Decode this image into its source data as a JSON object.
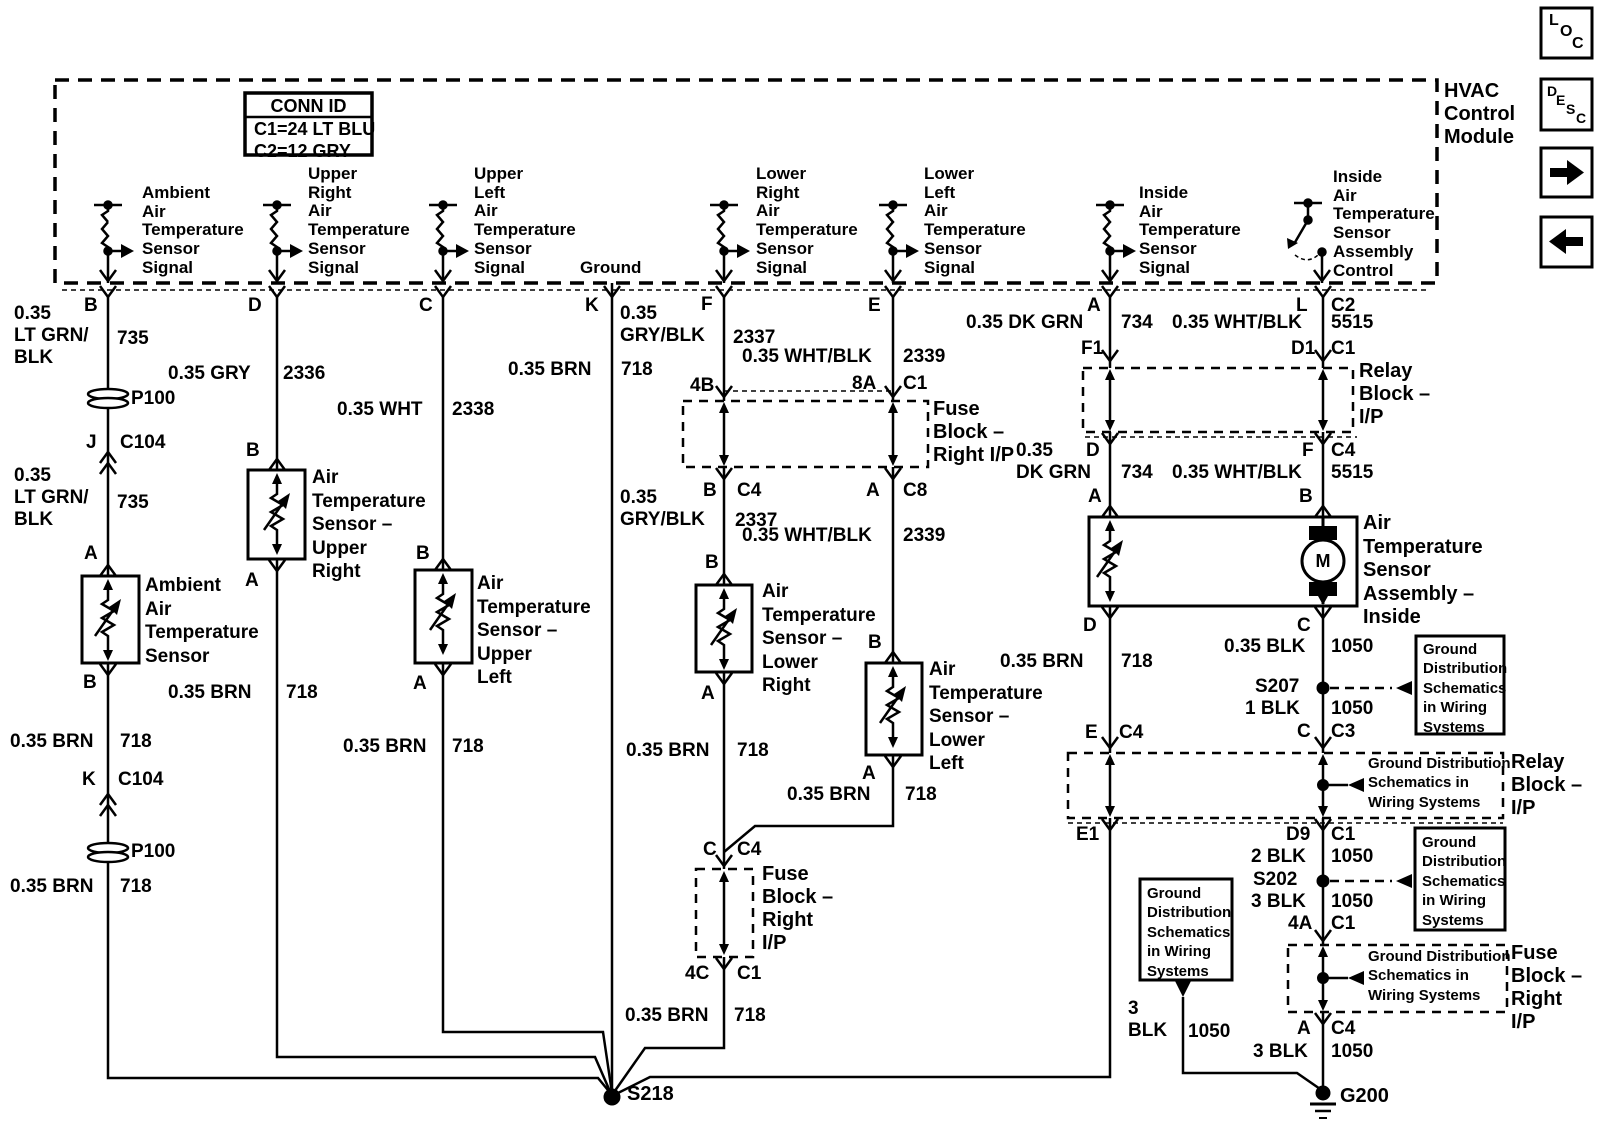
{
  "hdr": {
    "conn_title": "CONN ID",
    "conn_c1": "C1=24 LT BLU",
    "conn_c2": "C2=12 GRY",
    "module": "HVAC\nControl\nModule"
  },
  "icons": {
    "loc_l": "L",
    "loc_o": "O",
    "loc_c": "C",
    "desc_d": "D",
    "desc_e": "E",
    "desc_s": "S",
    "desc_c": "C"
  },
  "sens": {
    "ambient": "Ambient\nAir\nTemperature\nSensor\nSignal",
    "upper_right": "Upper\nRight\nAir\nTemperature\nSensor\nSignal",
    "upper_left": "Upper\nLeft\nAir\nTemperature\nSensor\nSignal",
    "ground": "Ground",
    "lower_right": "Lower\nRight\nAir\nTemperature\nSensor\nSignal",
    "lower_left": "Lower\nLeft\nAir\nTemperature\nSensor\nSignal",
    "inside": "Inside\nAir\nTemperature\nSensor\nSignal",
    "inside_ctrl": "Inside\nAir\nTemperature\nSensor\nAssembly\nControl"
  },
  "pins": {
    "b": "B",
    "d": "D",
    "c": "C",
    "k": "K",
    "f": "F",
    "e": "E",
    "a": "A",
    "l": "L",
    "c2": "C2"
  },
  "c1": {
    "w1": "0.35\nLT GRN/\nBLK",
    "n1": "735",
    "p100a": "P100",
    "pj": "J",
    "cj": "C104",
    "w2": "0.35\nLT GRN/\nBLK",
    "n2": "735",
    "pa": "A",
    "comp": "Ambient\nAir\nTemperature\nSensor",
    "pb": "B",
    "w3": "0.35 BRN",
    "n3": "718",
    "pk": "K",
    "ck": "C104",
    "p100b": "P100",
    "w4": "0.35 BRN",
    "n4": "718"
  },
  "c2": {
    "w1": "0.35 GRY",
    "n1": "2336",
    "pb": "B",
    "comp": "Air\nTemperature\nSensor –\nUpper\nRight",
    "pa": "A",
    "w2": "0.35 BRN",
    "n2": "718"
  },
  "c3": {
    "w1": "0.35 WHT",
    "n1": "2338",
    "pb": "B",
    "comp": "Air\nTemperature\nSensor –\nUpper\nLeft",
    "pa": "A",
    "w2": "0.35 BRN",
    "n2": "718"
  },
  "c4": {
    "w1": "0.35 BRN",
    "n1": "718"
  },
  "c5": {
    "w1": "0.35\nGRY/BLK",
    "n1": "2337",
    "p4b": "4B",
    "fuse1": "Fuse\nBlock –\nRight I/P",
    "pb": "B",
    "cc4": "C4",
    "w2": "0.35\nGRY/BLK",
    "n2": "2337",
    "pb2": "B",
    "comp": "Air\nTemperature\nSensor –\nLower\nRight",
    "pa": "A",
    "w3": "0.35 BRN",
    "n3": "718",
    "pc": "C",
    "cc4b": "C4",
    "fuse2": "Fuse\nBlock –\nRight\nI/P",
    "p4c": "4C",
    "cc1": "C1",
    "w4": "0.35 BRN",
    "n4": "718"
  },
  "c6": {
    "w1": "0.35 WHT/BLK",
    "n1": "2339",
    "p8a": "8A",
    "cc1": "C1",
    "pa": "A",
    "cc8": "C8",
    "w2": "0.35 WHT/BLK",
    "n2": "2339",
    "pb": "B",
    "comp": "Air\nTemperature\nSensor –\nLower\nLeft",
    "pa2": "A",
    "w3": "0.35 BRN",
    "n3": "718"
  },
  "c7": {
    "w1": "0.35 DK GRN",
    "n1": "734",
    "pf1": "F1",
    "w2": "0.35\nDK GRN",
    "pd": "D",
    "n2": "734",
    "pa": "A",
    "pd2": "D",
    "w3": "0.35 BRN",
    "n3": "718",
    "pe": "E",
    "ce": "C4",
    "pe1": "E1"
  },
  "c8": {
    "w1": "0.35 WHT/BLK",
    "n1": "5515",
    "pd1": "D1",
    "cc1": "C1",
    "relay1": "Relay\nBlock –\nI/P",
    "pf": "F",
    "cc4": "C4",
    "w2": "0.35 WHT/BLK",
    "n2": "5515",
    "pb": "B",
    "assembly": "Air\nTemperature\nSensor\nAssembly –\nInside",
    "motor": "M",
    "pc": "C",
    "w3": "0.35 BLK",
    "n3": "1050",
    "s207": "S207",
    "w4": "1 BLK",
    "n4": "1050",
    "pc2": "C",
    "cc3": "C3",
    "gd1": "Ground\nDistribution\nSchematics\nin Wiring\nSystems",
    "relay2": "Relay\nBlock –\nI/P",
    "gd2p": "Ground Distribution\nSchematics in\nWiring Systems",
    "pd9": "D9",
    "cc1b": "C1",
    "w5": "2 BLK",
    "n5": "1050",
    "s202": "S202",
    "gd2": "Ground\nDistribution\nSchematics\nin Wiring\nSystems",
    "w6": "3 BLK",
    "n6": "1050",
    "p4a": "4A",
    "cc1c": "C1",
    "fuse3": "Fuse\nBlock –\nRight\nI/P",
    "gd3p": "Ground Distribution\nSchematics in\nWiring Systems",
    "pa2": "A",
    "cc4b": "C4",
    "w7": "3 BLK",
    "n7": "1050",
    "g200": "G200"
  },
  "gd3": {
    "box": "Ground\nDistribution\nSchematics\nin Wiring\nSystems",
    "w": "3\nBLK",
    "n": "1050"
  },
  "splices": {
    "s218": "S218"
  }
}
